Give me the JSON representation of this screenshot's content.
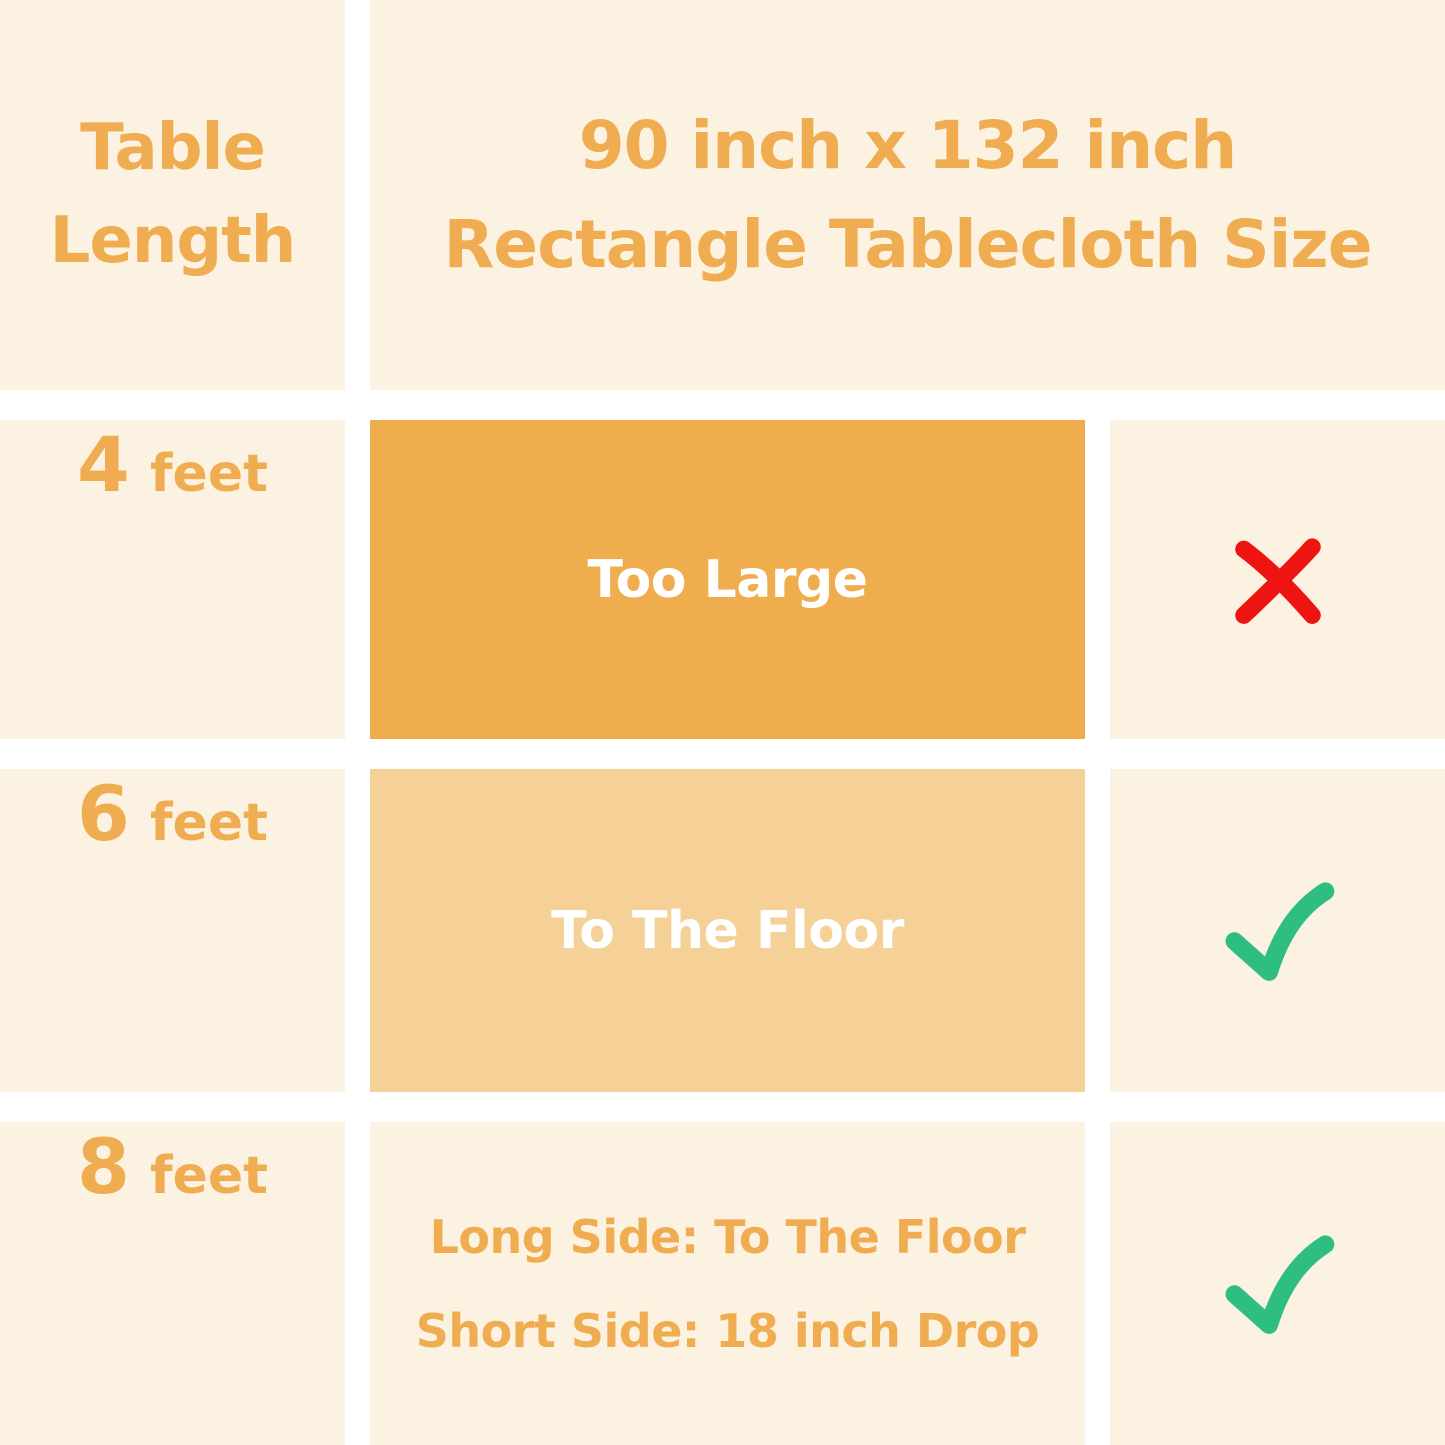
{
  "colors": {
    "background": "#FFFFFF",
    "cell_cream": "#FCF2E2",
    "box_dark_orange": "#EFAD4E",
    "box_light_orange": "#F5D197",
    "text_orange": "#F0AC50",
    "text_white": "#FFFFFF",
    "cross_red": "#EE1411",
    "check_green": "#2EBE82"
  },
  "header": {
    "row_label_line1": "Table",
    "row_label_line2": "Length",
    "title_line1": "90 inch x 132 inch",
    "title_line2": "Rectangle Tablecloth Size"
  },
  "rows": [
    {
      "value": "4",
      "unit": "feet",
      "fit_line1": "Too Large",
      "mark": "cross"
    },
    {
      "value": "6",
      "unit": "feet",
      "fit_line1": "To The Floor",
      "mark": "check"
    },
    {
      "value": "8",
      "unit": "feet",
      "fit_line1": "Long Side: To The Floor",
      "fit_line2": "Short Side: 18 inch Drop",
      "mark": "check"
    }
  ],
  "chart_data": {
    "type": "table",
    "title": "90 inch x 132 inch Rectangle Tablecloth Size",
    "row_header": "Table Length",
    "rows": [
      {
        "table_length": "4 feet",
        "fit": "Too Large",
        "suitable": false
      },
      {
        "table_length": "6 feet",
        "fit": "To The Floor",
        "suitable": true
      },
      {
        "table_length": "8 feet",
        "fit": "Long Side: To The Floor; Short Side: 18 inch Drop",
        "suitable": true
      }
    ],
    "legend_position": "none",
    "grid": "white gutters between cream cells"
  }
}
